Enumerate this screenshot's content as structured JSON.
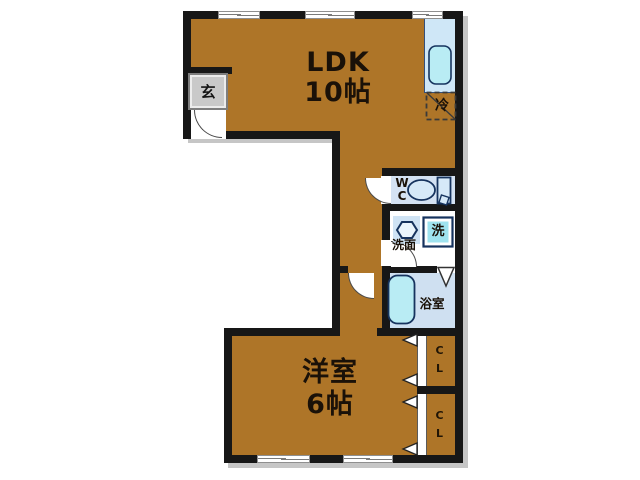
{
  "floorplan": {
    "rooms": {
      "ldk": {
        "name": "LDK",
        "size": "10帖"
      },
      "bedroom": {
        "name": "洋室",
        "size": "6帖"
      },
      "entrance": {
        "label": "玄"
      },
      "toilet": {
        "label_line1": "W",
        "label_line2": "C"
      },
      "washroom": {
        "label": "洗面"
      },
      "washing_machine": {
        "label": "洗"
      },
      "bathroom": {
        "label": "浴室"
      },
      "refrigerator": {
        "label": "冷"
      },
      "closet_upper": {
        "label_line1": "C",
        "label_line2": "L"
      },
      "closet_lower": {
        "label_line1": "C",
        "label_line2": "L"
      }
    },
    "colors": {
      "room_fill": "#ae7528",
      "wall": "#171717",
      "wc_floor": "#d4e2f3",
      "bath_floor": "#cfe0f1",
      "counter_blue": "#cfe7f7",
      "fixture_cyan": "#b9ecf4",
      "washer_cyan": "#9fe3ef",
      "fixture_outline": "#16335e",
      "entrance_gray": "#c9c9c9",
      "shadow_gray": "#c6c6c6"
    }
  }
}
